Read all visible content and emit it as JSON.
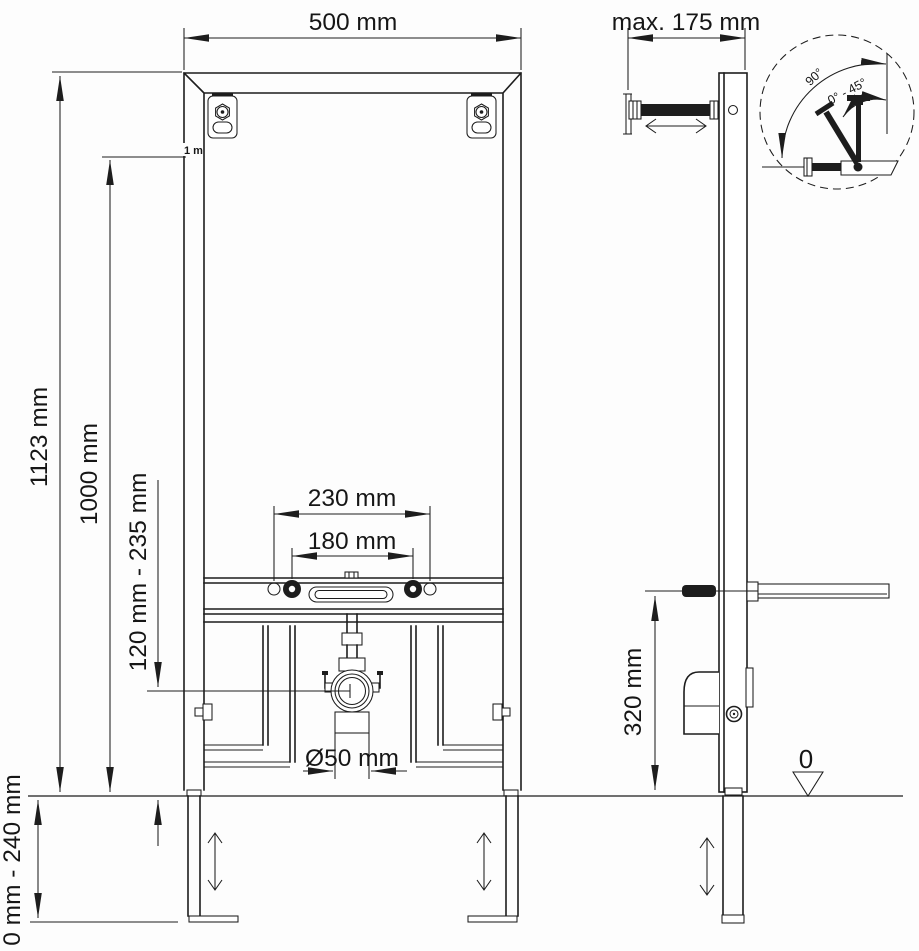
{
  "front_view": {
    "width": "500 mm",
    "total_height": "1123 mm",
    "upper_height": "1000 mm",
    "meter_mark": "1 m",
    "outlet_height_range": "120 mm - 235 mm",
    "foot_adjust_range": "0 mm - 240 mm",
    "fixing_spacing_outer": "230 mm",
    "fixing_spacing_inner": "180 mm",
    "drain_pipe_diameter": "Ø50 mm"
  },
  "side_view": {
    "wall_distance_max": "max. 175 mm",
    "drain_height": "320 mm",
    "floor_datum": "0"
  },
  "detail_view": {
    "swing_angle": "90°",
    "tilt_angle_range": "0° - 45°"
  }
}
